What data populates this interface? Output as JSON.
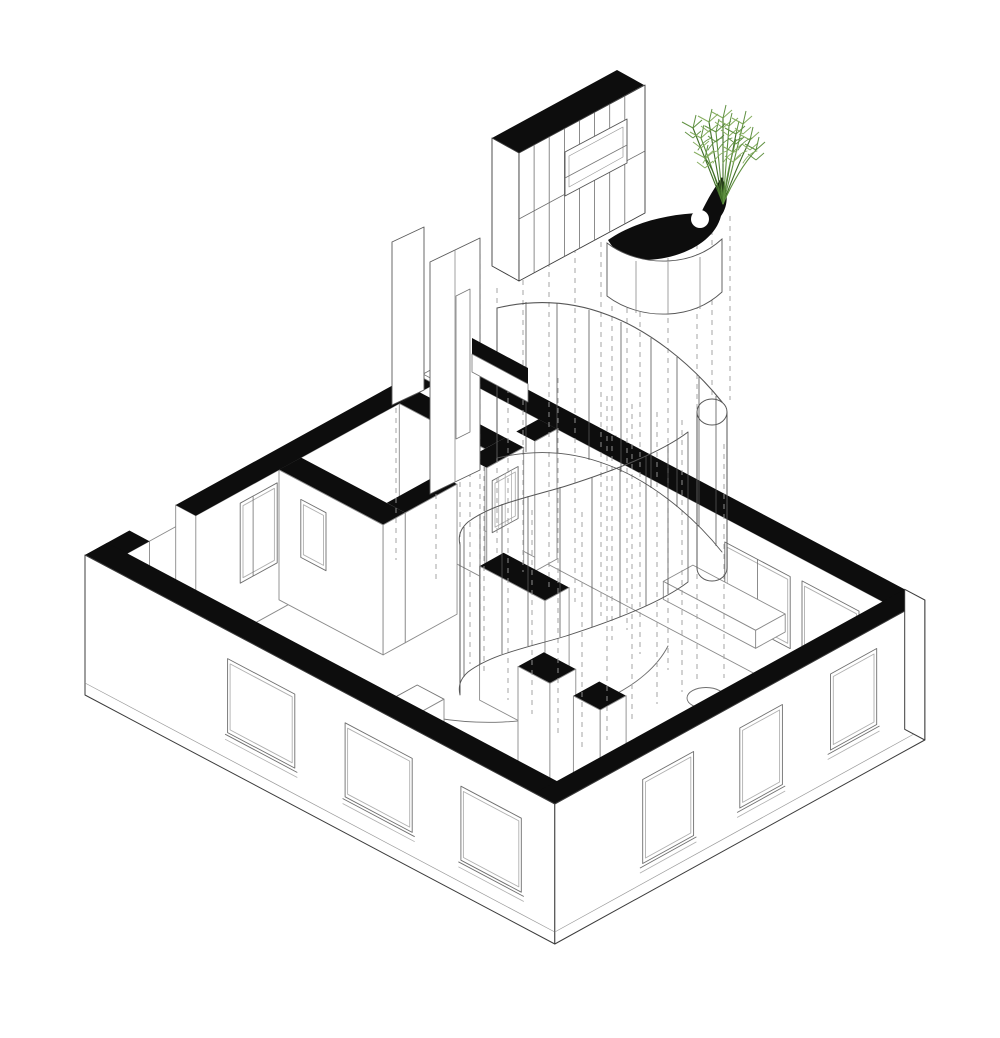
{
  "page": {
    "title": "Exploded axonometric drawing of an apartment floor plan",
    "background": "#ffffff"
  },
  "colors": {
    "ink": "#0d0d0d",
    "outline": "#3c3c3c",
    "line": "#6f6f6f",
    "faint": "#b0b0b0",
    "dashed": "#9c9c9c",
    "glass": "#565656",
    "fill": "#ffffff",
    "plant_dark": "#3f6d26",
    "plant_mid": "#5f9040",
    "plant_light": "#85ad5e"
  },
  "parts": [
    "floor-slab",
    "floor-projection-arcs",
    "interior-elevations",
    "interior-walls",
    "wall-cut-bands",
    "exterior-facades",
    "projection-lines",
    "curved-glass-partition",
    "floating-glass-panels",
    "exploded-cabinet-unit",
    "curved-canopy-wall",
    "potted-plant"
  ]
}
